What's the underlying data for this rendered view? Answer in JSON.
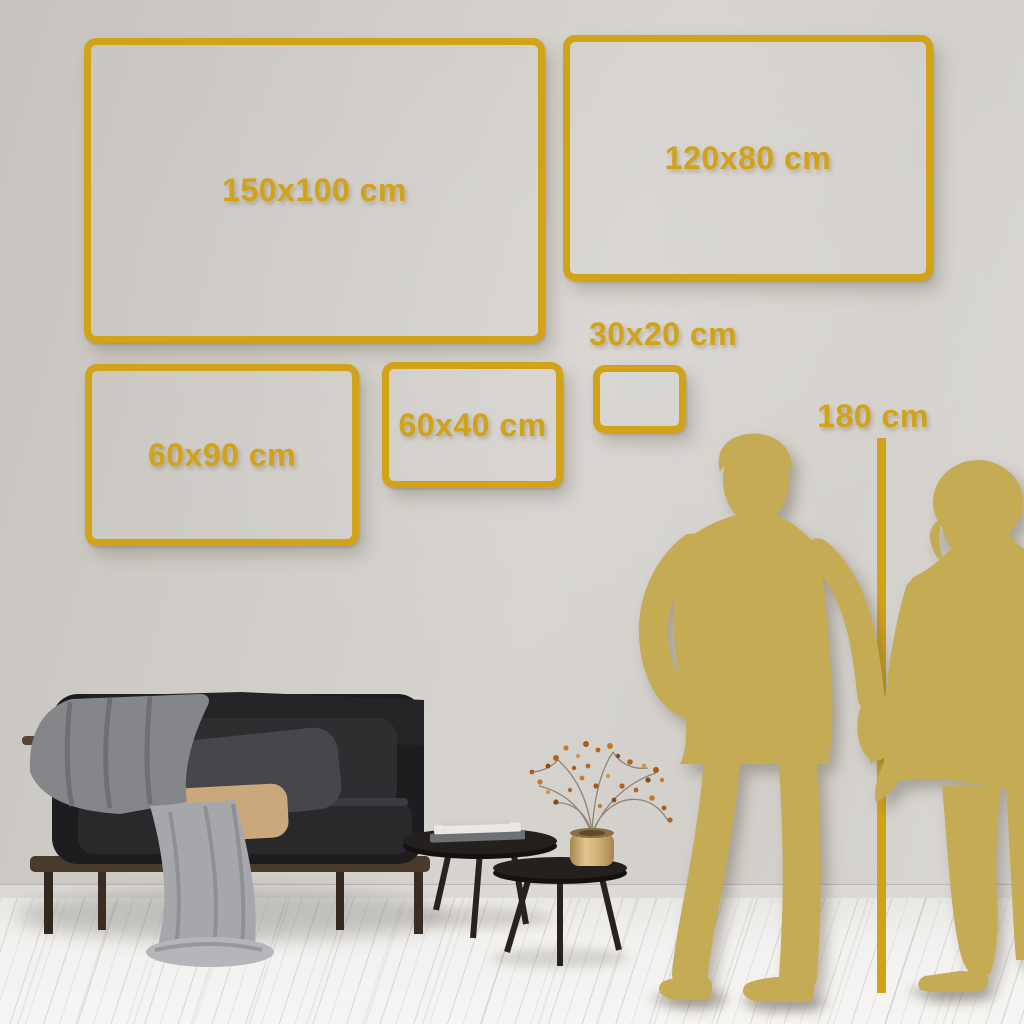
{
  "colors": {
    "accent_gold": "#D2A219",
    "silhouette_gold": "#C6AB55"
  },
  "size_guide": {
    "frames": [
      {
        "id": "150x100",
        "label": "150x100 cm"
      },
      {
        "id": "120x80",
        "label": "120x80 cm"
      },
      {
        "id": "60x90",
        "label": "60x90 cm"
      },
      {
        "id": "60x40",
        "label": "60x40 cm"
      },
      {
        "id": "30x20",
        "label": "30x20 cm"
      }
    ],
    "height_reference_label": "180 cm"
  }
}
